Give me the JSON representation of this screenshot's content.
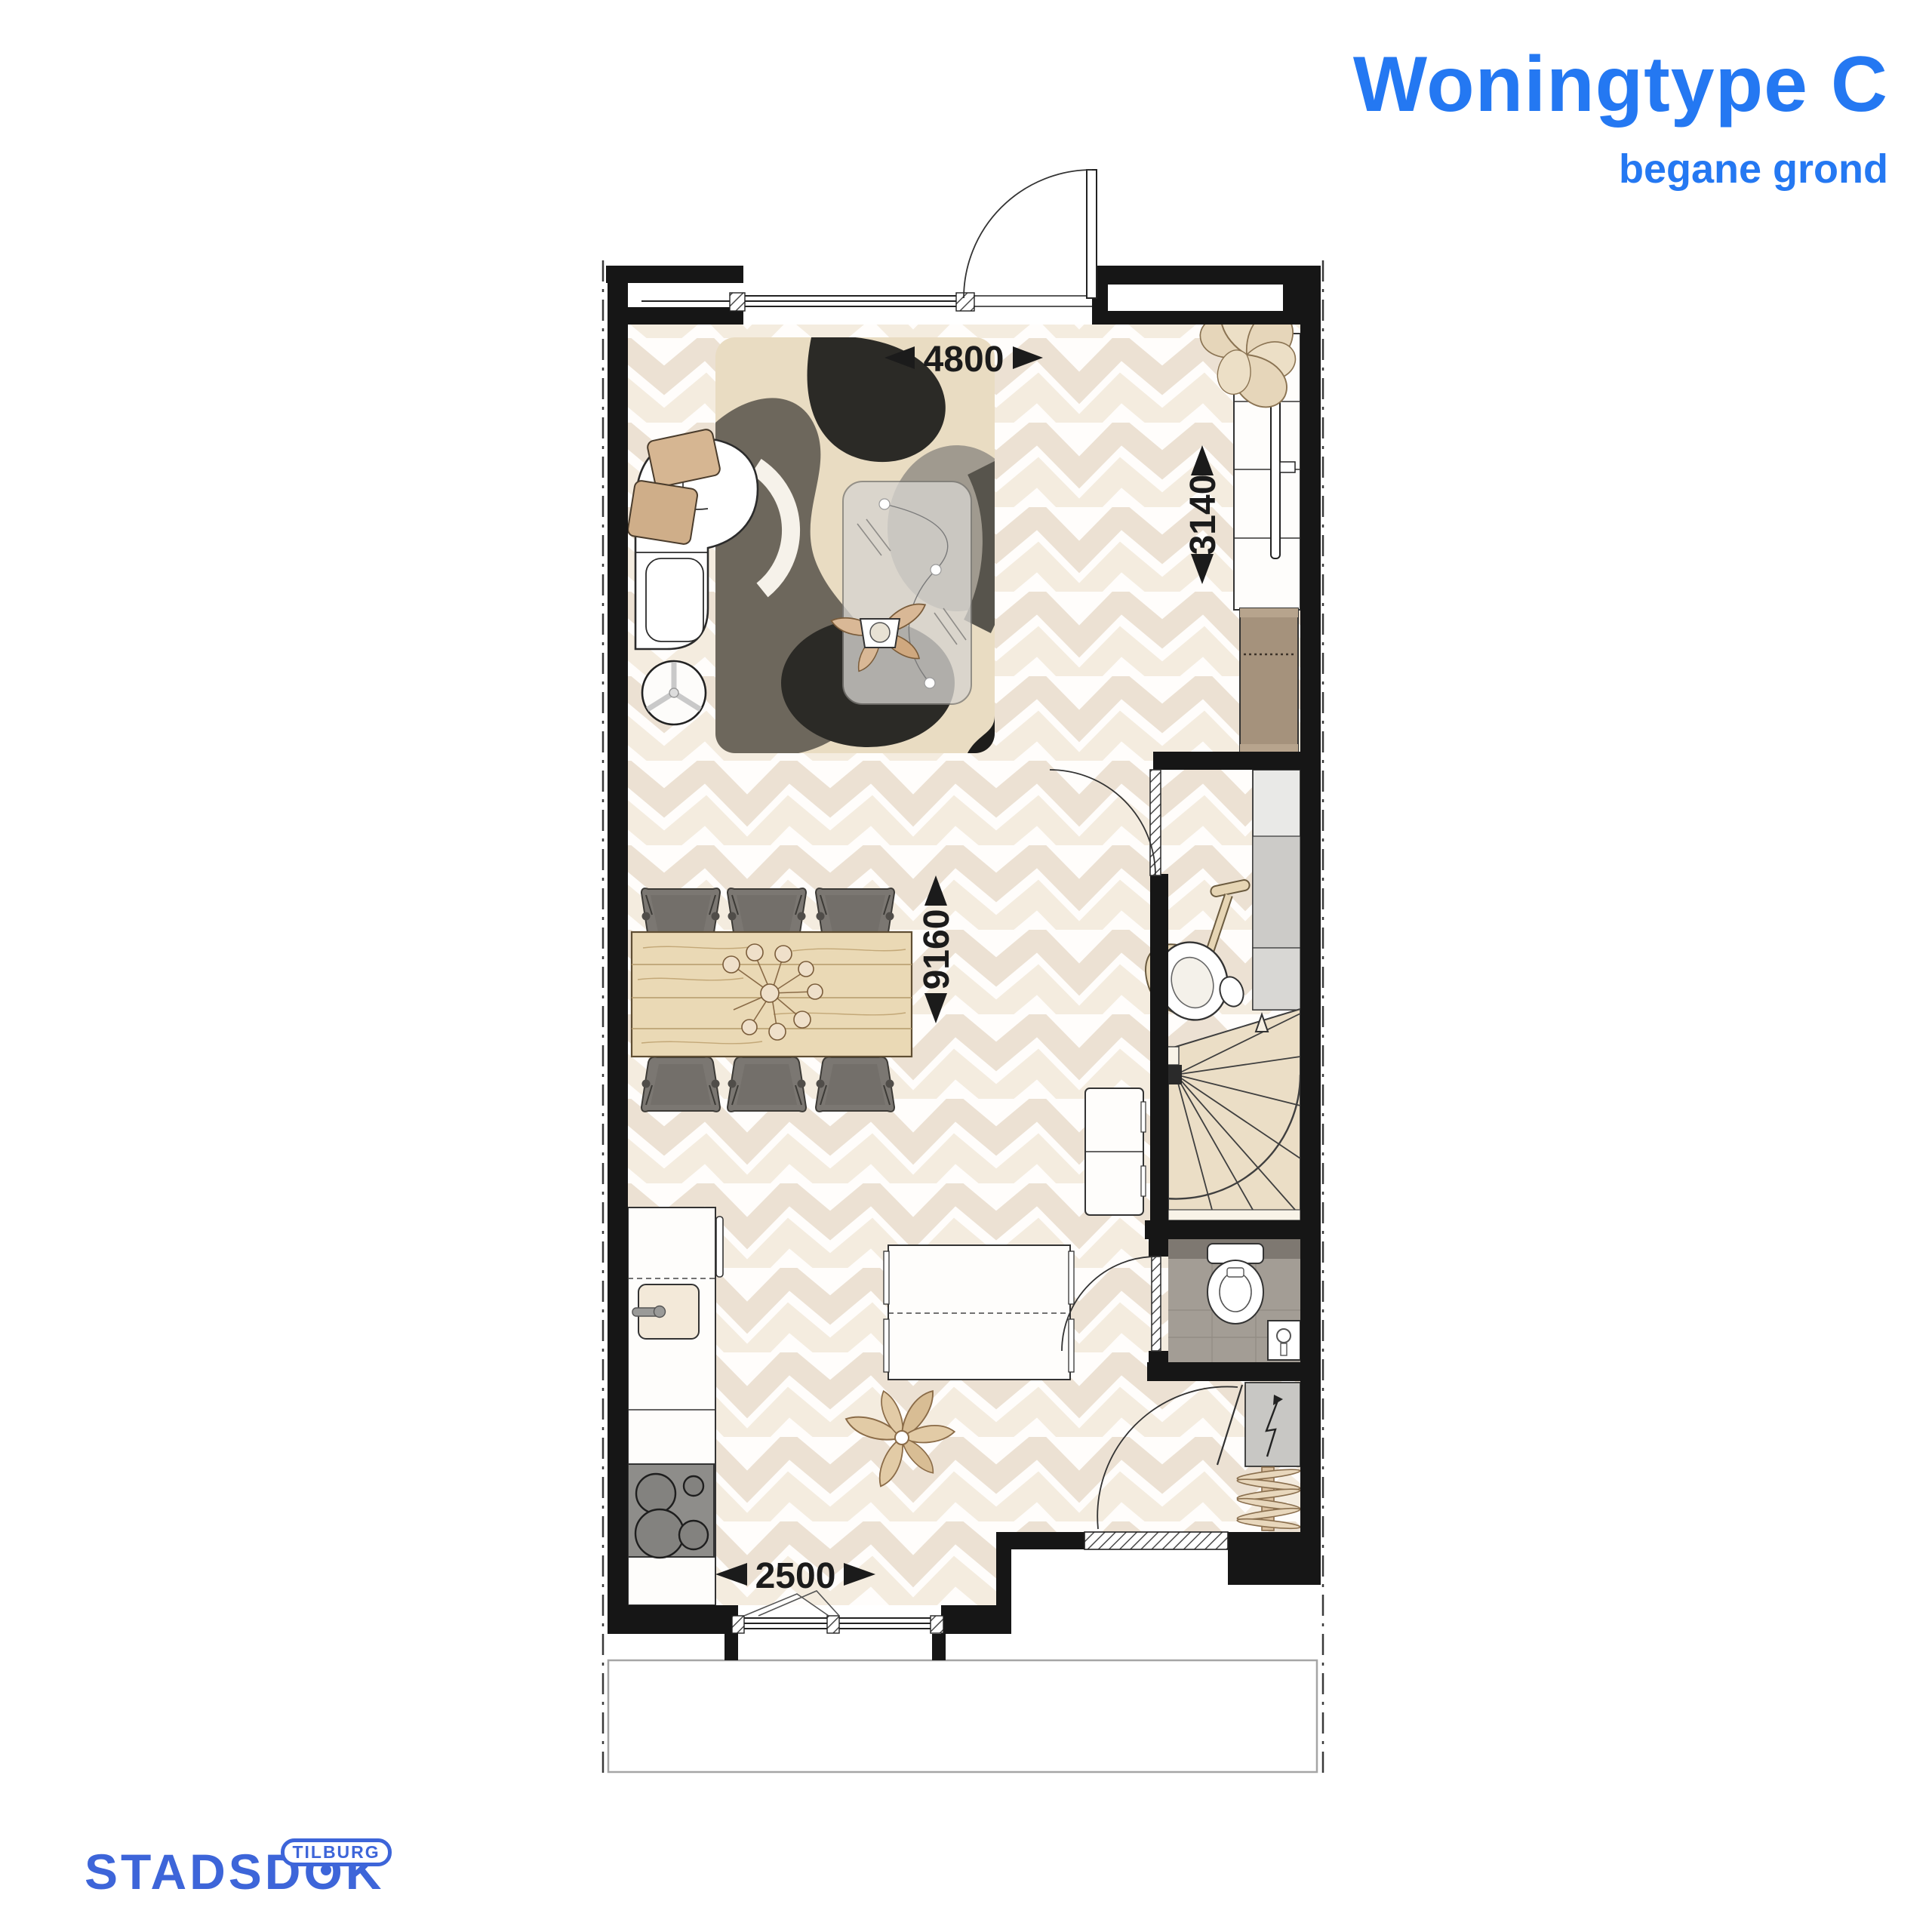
{
  "header": {
    "title": "Woningtype C",
    "subtitle": "begane grond"
  },
  "logo": {
    "brand_prefix": "STADSD",
    "brand_o": "O",
    "brand_suffix": "K",
    "badge": "TILBURG"
  },
  "dimensions": {
    "living_width": "4800",
    "living_depth": "3140",
    "total_depth": "9160",
    "kitchen_width": "2500"
  },
  "colors": {
    "accent_blue": "#2478f2",
    "logo_blue": "#3d65d9",
    "wall_black": "#161616",
    "floor_cream": "#ece1d3",
    "rug_beige": "#e9dcc2",
    "stair_beige": "#ebdec6",
    "toilet_gray": "#a39d95"
  }
}
